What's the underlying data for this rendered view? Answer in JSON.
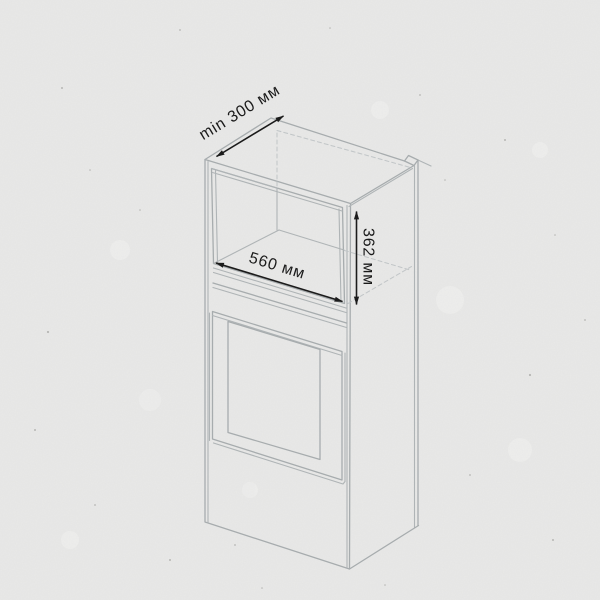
{
  "title": "Схема встраивания в нишу",
  "diagram": {
    "description_labels": {
      "niche_depth": "min 300 мм",
      "niche_width": "560 мм",
      "niche_height": "362 мм"
    }
  },
  "colors": {
    "background": "#e9e9e8",
    "cabinet_outline": "#a7acae",
    "hidden_line": "#c2c6c8",
    "dimension_ink": "#1b1b1b",
    "title_ink": "#121212"
  }
}
